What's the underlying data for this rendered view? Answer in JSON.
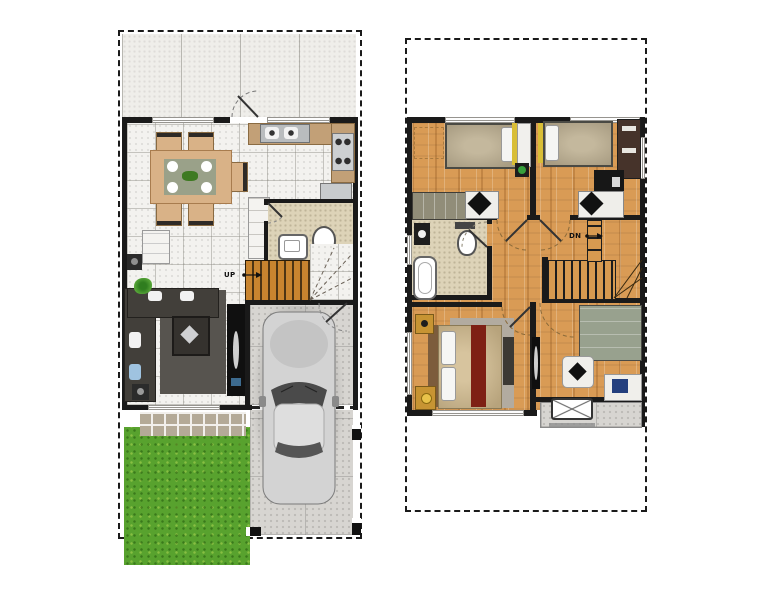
{
  "canvas": {
    "width": 761,
    "height": 590,
    "background": "#ffffff"
  },
  "labels": {
    "stairs_up": "UP",
    "stairs_down": "DN"
  },
  "colors": {
    "wall": "#1a1a1a",
    "tile": "#f3f2ef",
    "yard": "#efeeea",
    "wood": "#d99b55",
    "bath": "#ddd3b8",
    "lawn": "#58a22e",
    "concrete": "#d7d5d1",
    "stair": "#c8842f",
    "counter": "#c2a077",
    "paver": "#b4aa97",
    "sofa": "#423f3a",
    "rug-dark": "#57544f",
    "rug-light": "#b2aba0",
    "maroon": "#7e2014",
    "gold": "#c79433"
  }
}
